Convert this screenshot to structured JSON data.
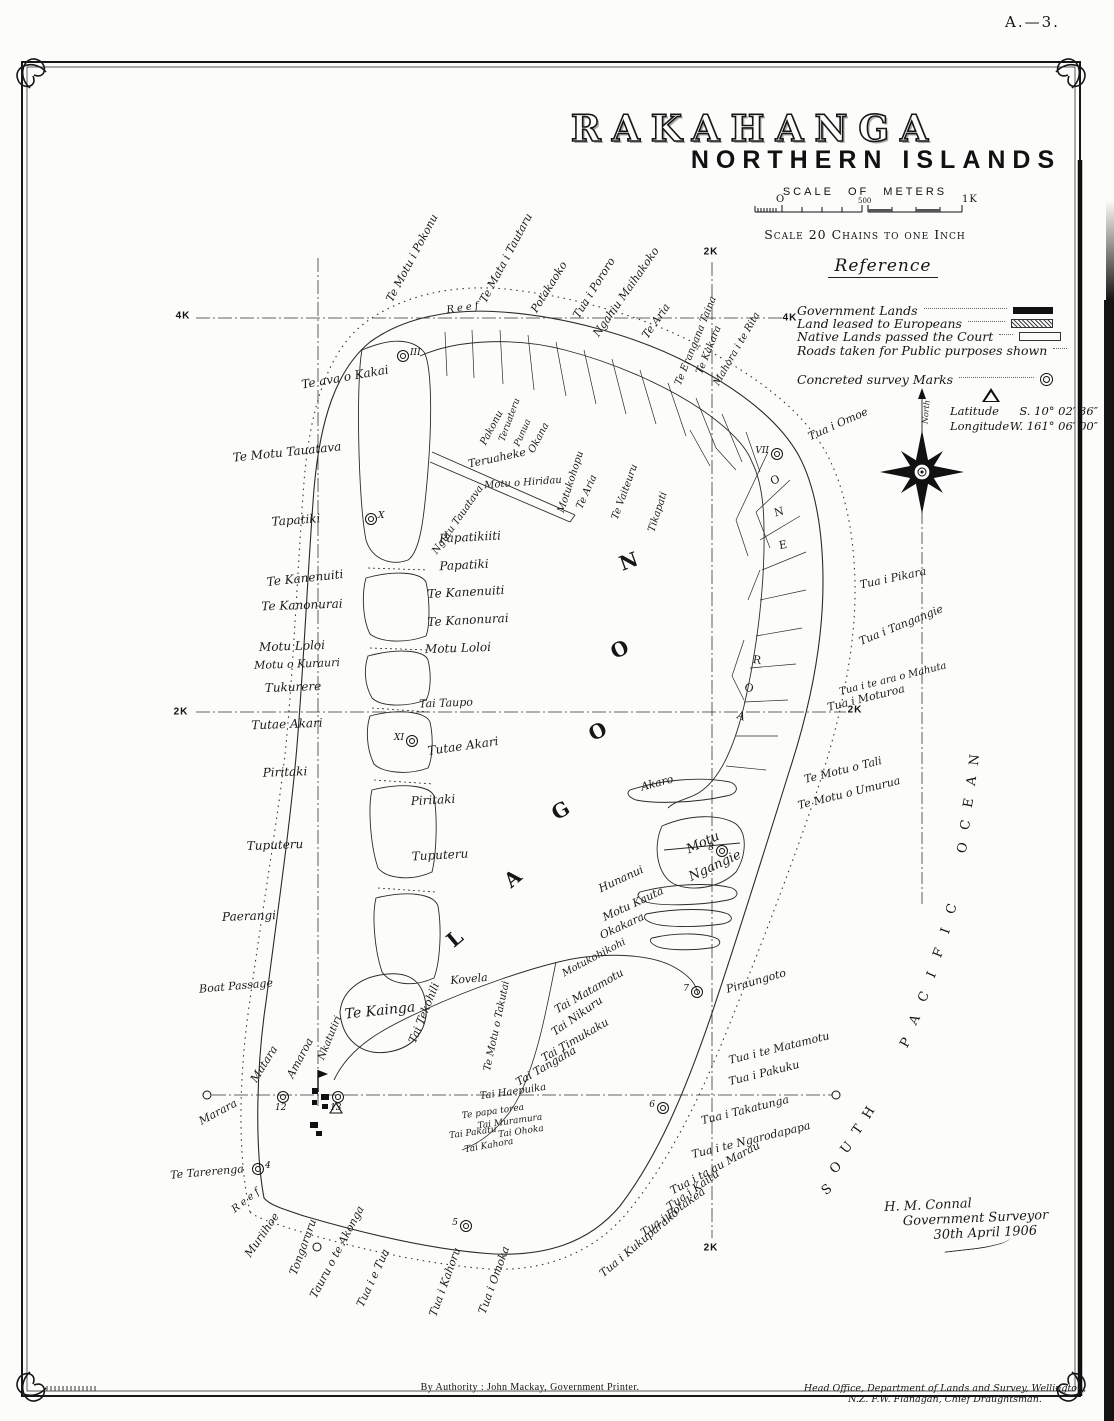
{
  "page": {
    "sheet_ref": "A.—3.",
    "footer_left": "By Authority : John Mackay, Government Printer.",
    "footer_right": "Head Office, Department of Lands and Survey, Wellington, N.Z. F.W. Flanagan, Chief Draughtsman."
  },
  "title": {
    "main": "RAKAHANGA",
    "sub": "NORTHERN ISLANDS",
    "scale_heading": "SCALE OF METERS",
    "scale_zero": "O",
    "scale_mid": "500",
    "scale_end": "1K",
    "scale_note": "Scale 20 Chains to one Inch"
  },
  "reference": {
    "heading": "Reference",
    "items": [
      {
        "label": "Government Lands",
        "swatch": "solid"
      },
      {
        "label": "Land leased to Europeans",
        "swatch": "hatched"
      },
      {
        "label": "Native Lands passed the Court",
        "swatch": "outline"
      },
      {
        "label": "Roads taken for Public purposes shown",
        "swatch": "line"
      }
    ],
    "marks_label": "Concreted survey Marks",
    "latitude_label": "Latitude",
    "latitude_value": "S. 10° 02′ 36″",
    "longitude_label": "Longitude",
    "longitude_value": "W. 161° 06′ 00″"
  },
  "signature": {
    "line1": "H. M. Connal",
    "line2": "Government Surveyor",
    "line3": "30th April 1906"
  },
  "map": {
    "ocean_name": "SOUTH PACIFIC OCEAN",
    "lagoon_name": "LAGOON",
    "grid_labels": [
      {
        "t": "4K",
        "x": 183,
        "y": 316
      },
      {
        "t": "4K",
        "x": 790,
        "y": 318
      },
      {
        "t": "2K",
        "x": 711,
        "y": 252
      },
      {
        "t": "2K",
        "x": 181,
        "y": 712
      },
      {
        "t": "2K",
        "x": 855,
        "y": 710
      },
      {
        "t": "2K",
        "x": 711,
        "y": 1248
      }
    ],
    "survey_marks": [
      {
        "n": "III",
        "x": 403,
        "y": 356
      },
      {
        "n": "X",
        "x": 371,
        "y": 519
      },
      {
        "n": "XI",
        "x": 412,
        "y": 741,
        "side": "l"
      },
      {
        "n": "VII",
        "x": 777,
        "y": 454,
        "side": "l"
      },
      {
        "n": "8",
        "x": 722,
        "y": 851,
        "side": "l"
      },
      {
        "n": "7",
        "x": 697,
        "y": 992,
        "side": "l"
      },
      {
        "n": "6",
        "x": 663,
        "y": 1108,
        "side": "l"
      },
      {
        "n": "5",
        "x": 466,
        "y": 1226,
        "side": "l"
      },
      {
        "n": "4",
        "x": 258,
        "y": 1169
      },
      {
        "n": "12",
        "x": 283,
        "y": 1097,
        "side": "b"
      },
      {
        "n": "13",
        "x": 338,
        "y": 1097,
        "side": "b"
      }
    ],
    "plain_marks": [
      {
        "x": 207,
        "y": 1095
      },
      {
        "x": 836,
        "y": 1095
      },
      {
        "x": 317,
        "y": 1247
      }
    ],
    "labels": [
      {
        "t": "Te ava o Kakai",
        "x": 345,
        "y": 377,
        "r": -10,
        "s": 12
      },
      {
        "t": "Te Motu Tauatava",
        "x": 287,
        "y": 452,
        "r": -6,
        "s": 12
      },
      {
        "t": "Tapatiki",
        "x": 296,
        "y": 520,
        "r": -4,
        "s": 12
      },
      {
        "t": "Te Kanenuiti",
        "x": 305,
        "y": 578,
        "r": -6,
        "s": 12
      },
      {
        "t": "Te Kanonurai",
        "x": 302,
        "y": 605,
        "r": -2,
        "s": 12
      },
      {
        "t": "Motu Loloi",
        "x": 292,
        "y": 646,
        "r": -2,
        "s": 12
      },
      {
        "t": "Motu o Kurauri",
        "x": 297,
        "y": 664,
        "r": -2,
        "s": 11
      },
      {
        "t": "Tukurere",
        "x": 293,
        "y": 687,
        "r": -2,
        "s": 12
      },
      {
        "t": "Tutae Akari",
        "x": 287,
        "y": 724,
        "r": -2,
        "s": 12
      },
      {
        "t": "Piritaki",
        "x": 285,
        "y": 772,
        "r": -2,
        "s": 12
      },
      {
        "t": "Tuputeru",
        "x": 275,
        "y": 845,
        "r": -2,
        "s": 12
      },
      {
        "t": "Paerangi",
        "x": 249,
        "y": 916,
        "r": -2,
        "s": 12
      },
      {
        "t": "Boat Passage",
        "x": 236,
        "y": 986,
        "r": -5,
        "s": 11
      },
      {
        "t": "Matara",
        "x": 264,
        "y": 1064,
        "r": -58,
        "s": 11
      },
      {
        "t": "Amaroa",
        "x": 300,
        "y": 1058,
        "r": -62,
        "s": 11
      },
      {
        "t": "Nkatutiri",
        "x": 330,
        "y": 1038,
        "r": -68,
        "s": 10
      },
      {
        "t": "Marara",
        "x": 218,
        "y": 1112,
        "r": -28,
        "s": 11
      },
      {
        "t": "Te Tarerenga",
        "x": 207,
        "y": 1172,
        "r": -5,
        "s": 11
      },
      {
        "t": "Muriihoe",
        "x": 262,
        "y": 1235,
        "r": -55,
        "s": 11
      },
      {
        "t": "Tongaruru",
        "x": 303,
        "y": 1247,
        "r": -70,
        "s": 11
      },
      {
        "t": "Tauru o te Akonga",
        "x": 337,
        "y": 1252,
        "r": -62,
        "s": 11
      },
      {
        "t": "Tua i e Tua",
        "x": 373,
        "y": 1278,
        "r": -65,
        "s": 11
      },
      {
        "t": "Tua i Kahoru",
        "x": 445,
        "y": 1282,
        "r": -70,
        "s": 11
      },
      {
        "t": "Tua i Omoka",
        "x": 494,
        "y": 1280,
        "r": -70,
        "s": 11
      },
      {
        "t": "Reef",
        "x": 247,
        "y": 1200,
        "r": -38,
        "s": 10,
        "ls": 3
      },
      {
        "t": "Reef",
        "x": 464,
        "y": 308,
        "r": -8,
        "s": 10,
        "ls": 3
      },
      {
        "t": "Te Motu i Pokonu",
        "x": 412,
        "y": 258,
        "r": -62,
        "s": 11
      },
      {
        "t": "Te Mata i Tautaru",
        "x": 506,
        "y": 258,
        "r": -62,
        "s": 11
      },
      {
        "t": "Potakaoko",
        "x": 549,
        "y": 287,
        "r": -58,
        "s": 11
      },
      {
        "t": "Tua i Pororo",
        "x": 594,
        "y": 288,
        "r": -58,
        "s": 11
      },
      {
        "t": "Ngahiu Maihakoko",
        "x": 626,
        "y": 292,
        "r": -55,
        "s": 11
      },
      {
        "t": "Te Aria",
        "x": 656,
        "y": 321,
        "r": -55,
        "s": 11
      },
      {
        "t": "Te Erangana Taina",
        "x": 696,
        "y": 341,
        "r": -68,
        "s": 10
      },
      {
        "t": "Te Kakara",
        "x": 709,
        "y": 350,
        "r": -68,
        "s": 10
      },
      {
        "t": "Mahora i te Rita",
        "x": 737,
        "y": 349,
        "r": -60,
        "s": 10
      },
      {
        "t": "Tua i Omoe",
        "x": 838,
        "y": 424,
        "r": -24,
        "s": 11
      },
      {
        "t": "North",
        "x": 926,
        "y": 412,
        "r": -85,
        "s": 8
      },
      {
        "t": "Pakonu",
        "x": 492,
        "y": 428,
        "r": -62,
        "s": 10
      },
      {
        "t": "Teruateru",
        "x": 510,
        "y": 420,
        "r": -70,
        "s": 9
      },
      {
        "t": "Punua",
        "x": 523,
        "y": 433,
        "r": -66,
        "s": 9
      },
      {
        "t": "Okana",
        "x": 539,
        "y": 438,
        "r": -62,
        "s": 10
      },
      {
        "t": "Teruaheke",
        "x": 497,
        "y": 458,
        "r": -12,
        "s": 11
      },
      {
        "t": "Motu o Hiridau",
        "x": 523,
        "y": 483,
        "r": -4,
        "s": 10
      },
      {
        "t": "Ngutu Tauatava",
        "x": 458,
        "y": 520,
        "r": -55,
        "s": 10
      },
      {
        "t": "Motukohopu",
        "x": 571,
        "y": 482,
        "r": -72,
        "s": 10
      },
      {
        "t": "Te Aria",
        "x": 587,
        "y": 492,
        "r": -66,
        "s": 10
      },
      {
        "t": "Te Vaiteuru",
        "x": 625,
        "y": 492,
        "r": -70,
        "s": 10
      },
      {
        "t": "Tikapati",
        "x": 658,
        "y": 512,
        "r": -72,
        "s": 10
      },
      {
        "t": "Papatikiiti",
        "x": 470,
        "y": 537,
        "r": -3,
        "s": 12
      },
      {
        "t": "Papatiki",
        "x": 464,
        "y": 565,
        "r": -3,
        "s": 12
      },
      {
        "t": "Te Kanenuiti",
        "x": 466,
        "y": 592,
        "r": -3,
        "s": 12
      },
      {
        "t": "Te Kanonurai",
        "x": 468,
        "y": 620,
        "r": -3,
        "s": 12
      },
      {
        "t": "Motu Loloi",
        "x": 458,
        "y": 648,
        "r": -2,
        "s": 12
      },
      {
        "t": "Tai Taupo",
        "x": 446,
        "y": 703,
        "r": -2,
        "s": 11
      },
      {
        "t": "Tutae Akari",
        "x": 463,
        "y": 746,
        "r": -8,
        "s": 12
      },
      {
        "t": "Piritaki",
        "x": 433,
        "y": 800,
        "r": -3,
        "s": 12
      },
      {
        "t": "Tuputeru",
        "x": 440,
        "y": 855,
        "r": -3,
        "s": 12
      },
      {
        "t": "Kovela",
        "x": 469,
        "y": 979,
        "r": -5,
        "s": 11
      },
      {
        "t": "Te Kainga",
        "x": 380,
        "y": 1011,
        "r": -6,
        "s": 14
      },
      {
        "t": "Tai Tekohili",
        "x": 424,
        "y": 1013,
        "r": -68,
        "s": 11
      },
      {
        "t": "Te Motu o Takutai",
        "x": 497,
        "y": 1026,
        "r": -78,
        "s": 10
      },
      {
        "t": "Tai Tangaha",
        "x": 546,
        "y": 1066,
        "r": -30,
        "s": 11
      },
      {
        "t": "Tai Haepuika",
        "x": 513,
        "y": 1092,
        "r": -8,
        "s": 10
      },
      {
        "t": "Te papa torea",
        "x": 493,
        "y": 1112,
        "r": -8,
        "s": 9
      },
      {
        "t": "Tai Muramura",
        "x": 510,
        "y": 1122,
        "r": -8,
        "s": 9
      },
      {
        "t": "Tai Pakatu",
        "x": 473,
        "y": 1133,
        "r": -8,
        "s": 9
      },
      {
        "t": "Tai Ohoka",
        "x": 521,
        "y": 1132,
        "r": -8,
        "s": 9
      },
      {
        "t": "Tai Kahora",
        "x": 489,
        "y": 1146,
        "r": -10,
        "s": 9
      },
      {
        "t": "Motukohikohi",
        "x": 594,
        "y": 958,
        "r": -28,
        "s": 10
      },
      {
        "t": "Tai Matamotu",
        "x": 589,
        "y": 991,
        "r": -30,
        "s": 11
      },
      {
        "t": "Tai Nikuru",
        "x": 577,
        "y": 1016,
        "r": -35,
        "s": 11
      },
      {
        "t": "Tai Timukaku",
        "x": 575,
        "y": 1040,
        "r": -30,
        "s": 11
      },
      {
        "t": "Akaro",
        "x": 657,
        "y": 783,
        "r": -15,
        "s": 11
      },
      {
        "t": "Motu",
        "x": 703,
        "y": 843,
        "r": -25,
        "s": 13
      },
      {
        "t": "Ngangie",
        "x": 715,
        "y": 866,
        "r": -25,
        "s": 13
      },
      {
        "t": "Hunanui",
        "x": 621,
        "y": 879,
        "r": -25,
        "s": 11
      },
      {
        "t": "Motu Kauta",
        "x": 633,
        "y": 904,
        "r": -25,
        "s": 11
      },
      {
        "t": "Okakara",
        "x": 622,
        "y": 926,
        "r": -25,
        "s": 11
      },
      {
        "t": "Tua i Pikara",
        "x": 893,
        "y": 578,
        "r": -12,
        "s": 11
      },
      {
        "t": "Tua i Tangangie",
        "x": 901,
        "y": 625,
        "r": -22,
        "s": 11
      },
      {
        "t": "Tua i te ara o Mahuta",
        "x": 893,
        "y": 679,
        "r": -14,
        "s": 10
      },
      {
        "t": "Tua i Moturoa",
        "x": 866,
        "y": 698,
        "r": -14,
        "s": 11
      },
      {
        "t": "Te Motu o Tali",
        "x": 843,
        "y": 770,
        "r": -14,
        "s": 11
      },
      {
        "t": "Te Motu o Umurua",
        "x": 849,
        "y": 793,
        "r": -14,
        "s": 11
      },
      {
        "t": "Piraungoto",
        "x": 756,
        "y": 981,
        "r": -16,
        "s": 11
      },
      {
        "t": "Tua i te Matamotu",
        "x": 779,
        "y": 1048,
        "r": -14,
        "s": 11
      },
      {
        "t": "Tua i Pakuku",
        "x": 764,
        "y": 1073,
        "r": -14,
        "s": 11
      },
      {
        "t": "Tua i Takatunga",
        "x": 745,
        "y": 1110,
        "r": -14,
        "s": 11
      },
      {
        "t": "Tua i te Ngarodapapa",
        "x": 751,
        "y": 1140,
        "r": -14,
        "s": 11
      },
      {
        "t": "Tua i ta au Marau",
        "x": 715,
        "y": 1168,
        "r": -28,
        "s": 11
      },
      {
        "t": "Tua i Kaitu",
        "x": 693,
        "y": 1190,
        "r": -35,
        "s": 11
      },
      {
        "t": "Tua i Potakea",
        "x": 673,
        "y": 1212,
        "r": -35,
        "s": 11
      },
      {
        "t": "Tua i Kukuparako",
        "x": 639,
        "y": 1243,
        "r": -40,
        "s": 11
      },
      {
        "t": "L",
        "x": 455,
        "y": 938,
        "r": -40,
        "s": 20,
        "c": "big"
      },
      {
        "t": "A",
        "x": 513,
        "y": 878,
        "r": -40,
        "s": 20,
        "c": "big"
      },
      {
        "t": "G",
        "x": 561,
        "y": 810,
        "r": -30,
        "s": 20,
        "c": "big"
      },
      {
        "t": "O",
        "x": 598,
        "y": 731,
        "r": -25,
        "s": 20,
        "c": "big"
      },
      {
        "t": "O",
        "x": 620,
        "y": 649,
        "r": -25,
        "s": 20,
        "c": "big"
      },
      {
        "t": "N",
        "x": 629,
        "y": 561,
        "r": -20,
        "s": 20,
        "c": "big"
      },
      {
        "t": "O",
        "x": 775,
        "y": 480,
        "r": -20,
        "s": 11,
        "c": "band"
      },
      {
        "t": "N",
        "x": 779,
        "y": 512,
        "r": -15,
        "s": 11,
        "c": "band"
      },
      {
        "t": "E",
        "x": 783,
        "y": 545,
        "r": -10,
        "s": 11,
        "c": "band"
      },
      {
        "t": "R",
        "x": 757,
        "y": 660,
        "r": 10,
        "s": 11,
        "c": "band"
      },
      {
        "t": "O",
        "x": 749,
        "y": 688,
        "r": 15,
        "s": 11,
        "c": "band"
      },
      {
        "t": "A",
        "x": 741,
        "y": 716,
        "r": 20,
        "s": 11,
        "c": "band"
      },
      {
        "t": "S",
        "x": 827,
        "y": 1190,
        "r": -40,
        "s": 13,
        "c": "cap"
      },
      {
        "t": "O",
        "x": 836,
        "y": 1168,
        "r": -45,
        "s": 13,
        "c": "cap"
      },
      {
        "t": "U",
        "x": 847,
        "y": 1148,
        "r": -50,
        "s": 13,
        "c": "cap"
      },
      {
        "t": "T",
        "x": 858,
        "y": 1130,
        "r": -55,
        "s": 13,
        "c": "cap"
      },
      {
        "t": "H",
        "x": 869,
        "y": 1113,
        "r": -58,
        "s": 13,
        "c": "cap"
      },
      {
        "t": "P",
        "x": 906,
        "y": 1043,
        "r": -60,
        "s": 13,
        "c": "cap"
      },
      {
        "t": "A",
        "x": 915,
        "y": 1020,
        "r": -62,
        "s": 13,
        "c": "cap"
      },
      {
        "t": "C",
        "x": 924,
        "y": 997,
        "r": -64,
        "s": 13,
        "c": "cap"
      },
      {
        "t": "I",
        "x": 932,
        "y": 975,
        "r": -66,
        "s": 13,
        "c": "cap"
      },
      {
        "t": "F",
        "x": 939,
        "y": 953,
        "r": -68,
        "s": 13,
        "c": "cap"
      },
      {
        "t": "I",
        "x": 946,
        "y": 931,
        "r": -70,
        "s": 13,
        "c": "cap"
      },
      {
        "t": "C",
        "x": 952,
        "y": 909,
        "r": -72,
        "s": 13,
        "c": "cap"
      },
      {
        "t": "O",
        "x": 963,
        "y": 848,
        "r": -75,
        "s": 13,
        "c": "cap"
      },
      {
        "t": "C",
        "x": 966,
        "y": 825,
        "r": -78,
        "s": 13,
        "c": "cap"
      },
      {
        "t": "E",
        "x": 969,
        "y": 803,
        "r": -80,
        "s": 13,
        "c": "cap"
      },
      {
        "t": "A",
        "x": 972,
        "y": 781,
        "r": -82,
        "s": 13,
        "c": "cap"
      },
      {
        "t": "N",
        "x": 975,
        "y": 760,
        "r": -84,
        "s": 13,
        "c": "cap"
      }
    ]
  }
}
